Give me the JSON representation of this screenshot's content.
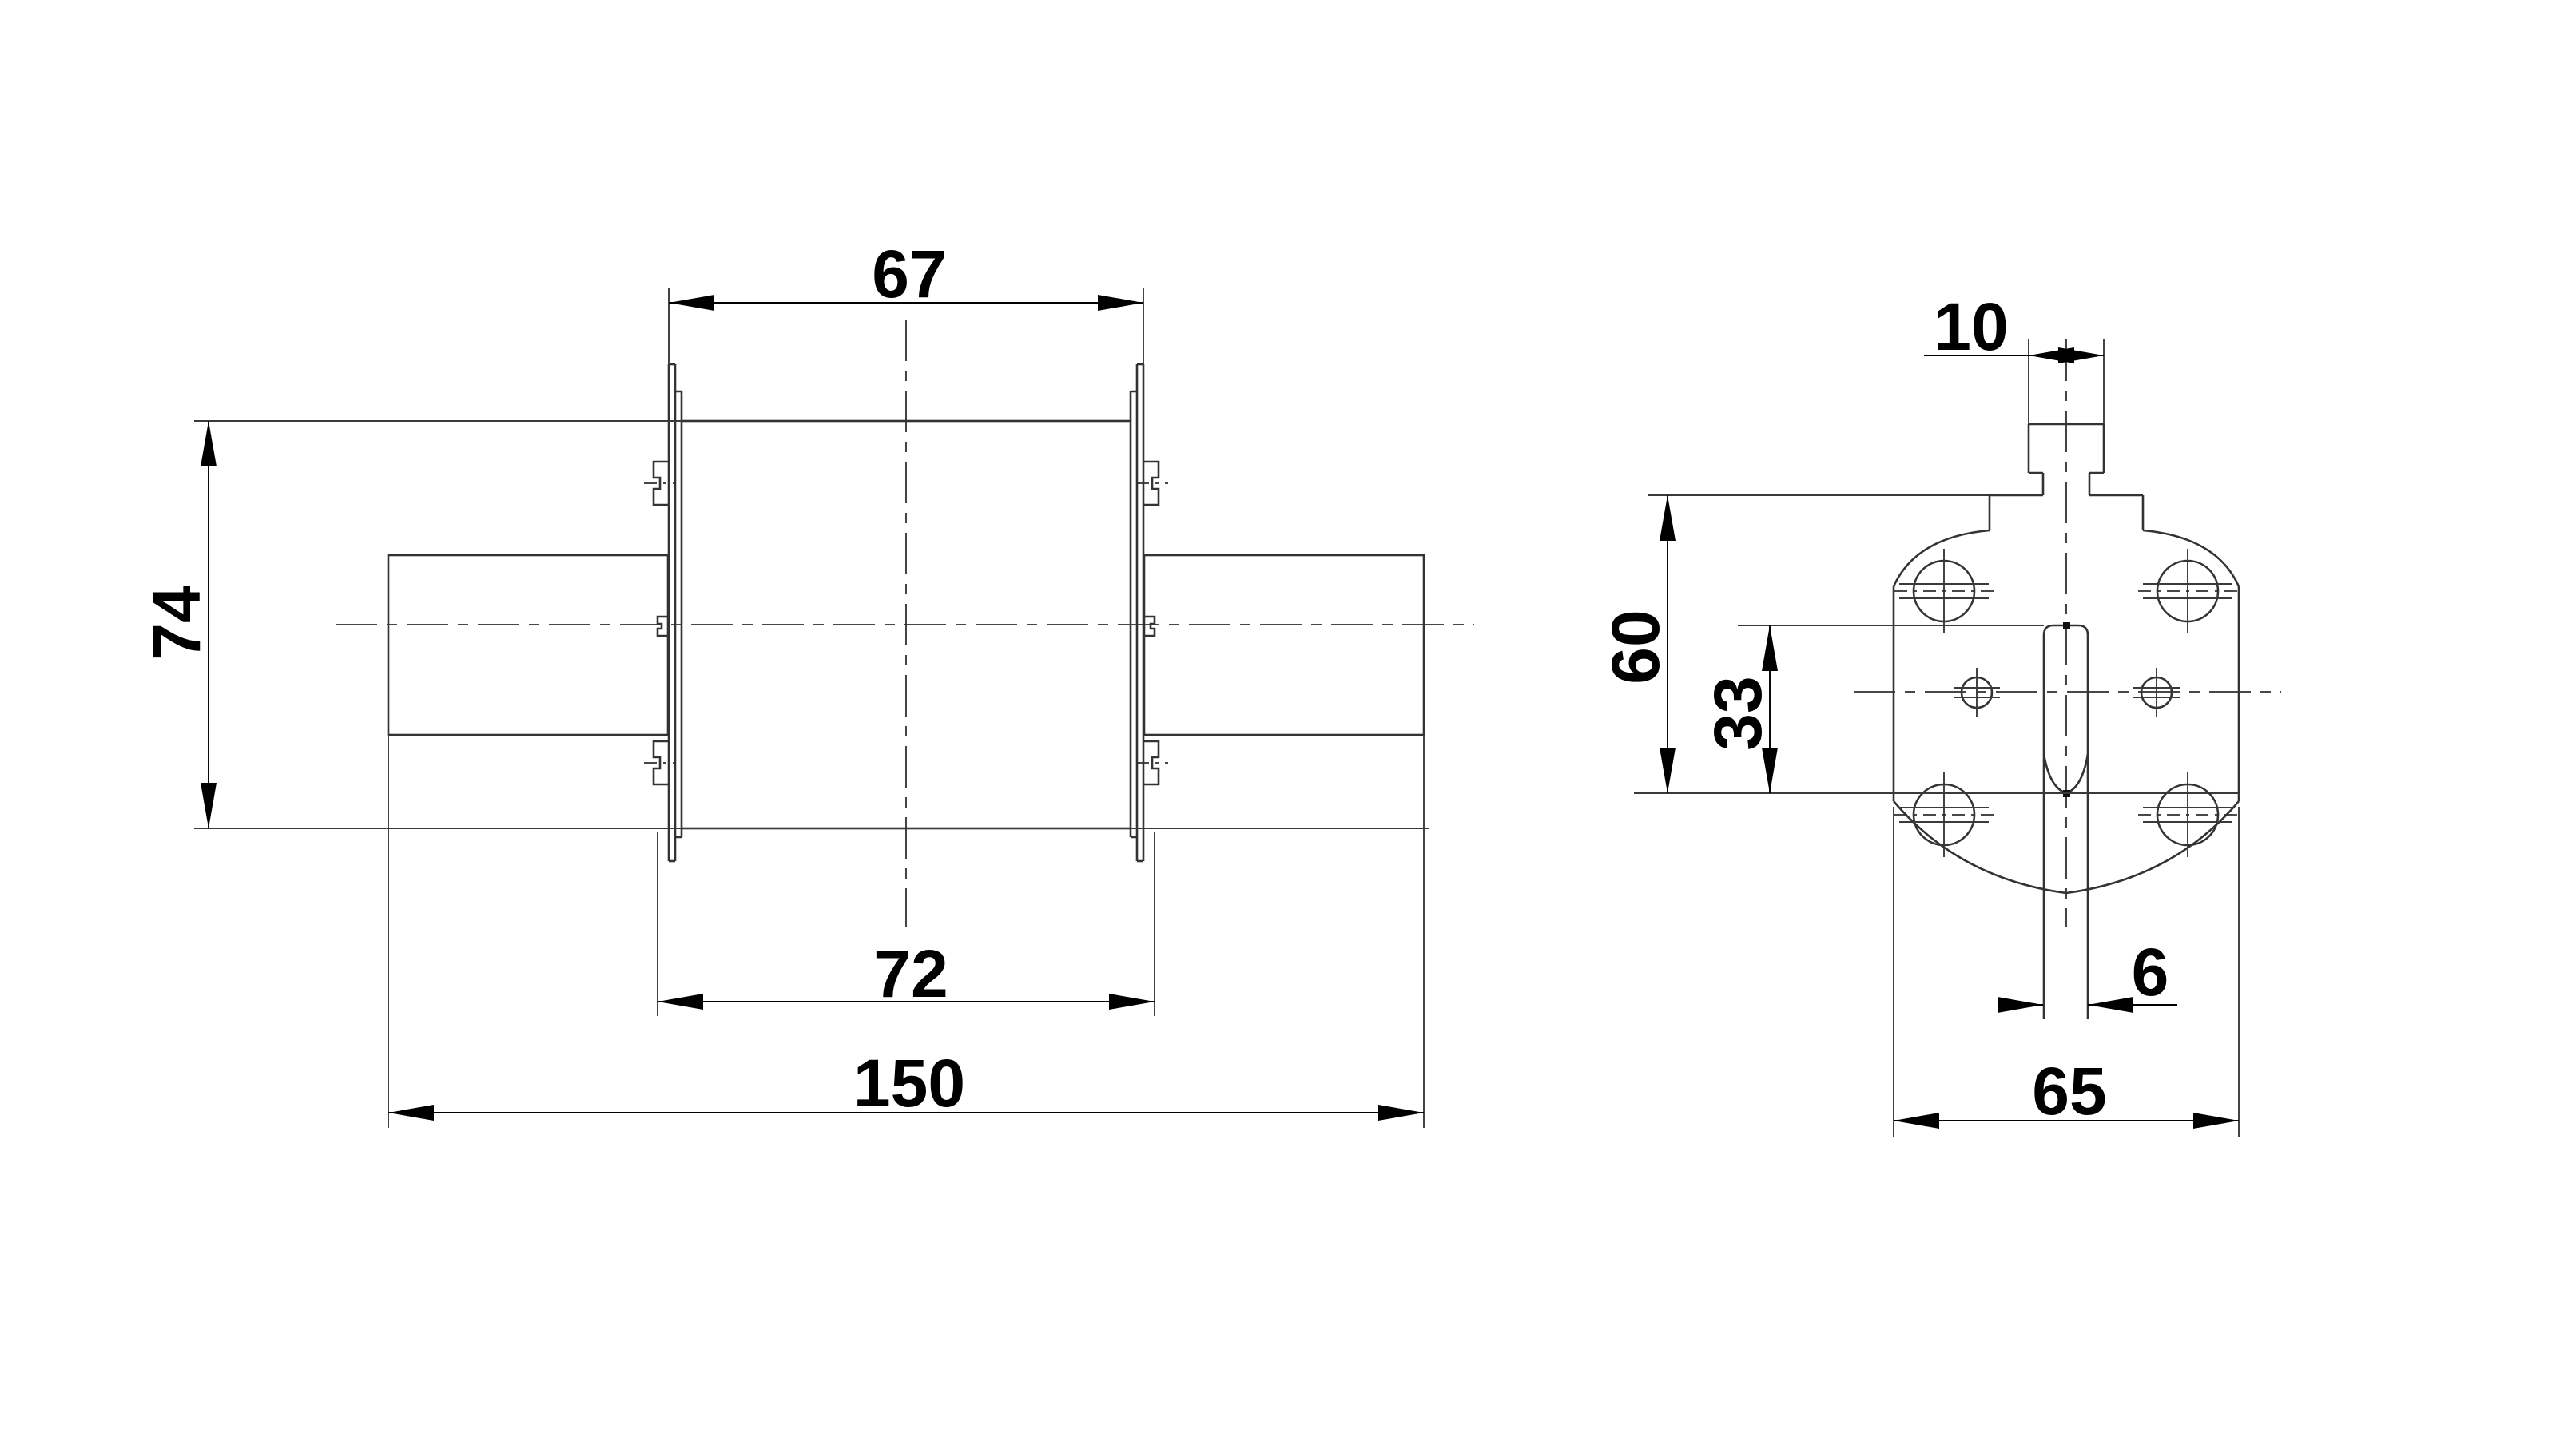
{
  "drawing": {
    "type": "technical-dimension-drawing",
    "views": {
      "front": {
        "dims": {
          "top_width": "67",
          "height": "74",
          "bottom_width": "72",
          "total_length": "150"
        }
      },
      "side": {
        "dims": {
          "tab_width": "10",
          "plate_height": "60",
          "blade_height": "33",
          "blade_thickness": "6",
          "plate_width": "65"
        }
      }
    },
    "colors": {
      "background": "#ffffff",
      "outline": "#333333",
      "dimension": "#000000"
    }
  }
}
